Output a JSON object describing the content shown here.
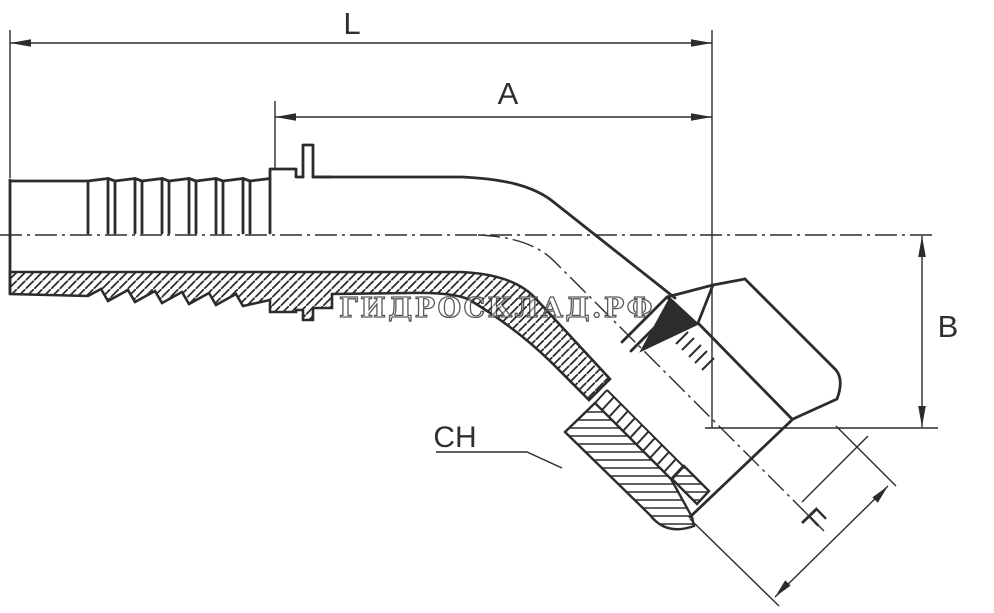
{
  "page": {
    "type": "technical-drawing",
    "subject": "45-degree hydraulic hose elbow fitting, half-section view",
    "background_color": "#ffffff",
    "line_color": "#2c2c2c",
    "label_color": "#2f2f2f"
  },
  "watermark": {
    "text": "ГИДРОСКЛАД.РФ"
  },
  "dimensions": {
    "overall_length_label": "L",
    "shank_length_label": "A",
    "drop_height_label": "B",
    "wrench_size_label": "CH",
    "thread_size_label": "F"
  }
}
